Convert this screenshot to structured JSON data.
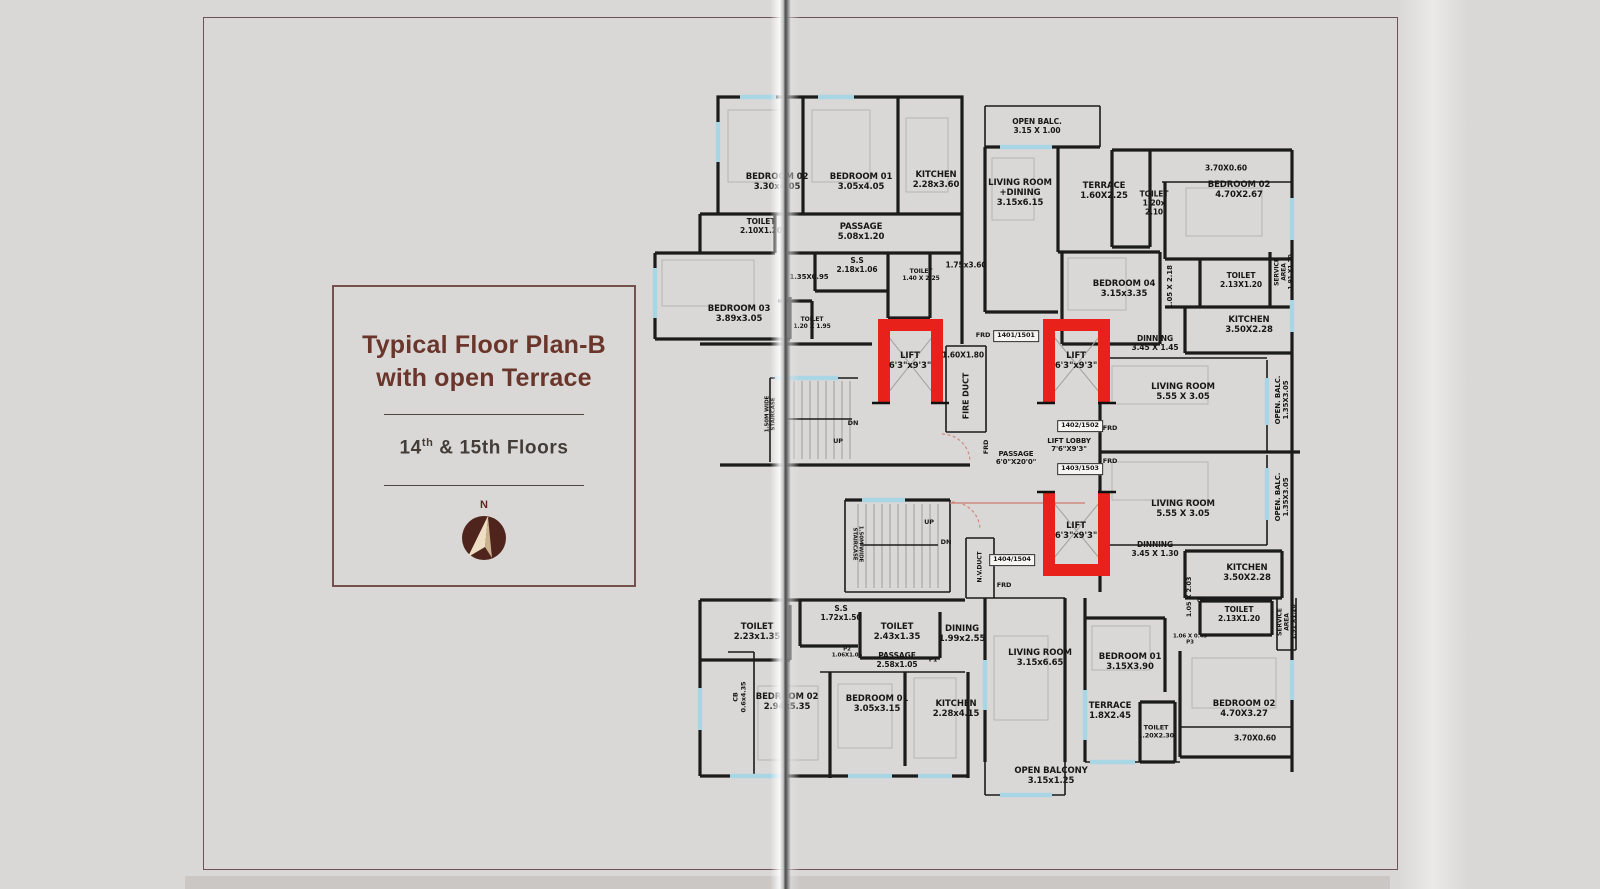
{
  "panel": {
    "title_line1": "Typical Floor Plan-B",
    "title_line2": "with open Terrace",
    "subtitle_prefix": "14",
    "subtitle_sup": "th",
    "subtitle_rest": " & 15th Floors",
    "compass_label": "N",
    "accent_color": "#6a352a"
  },
  "plan": {
    "lift_color": "#e8211b",
    "window_color": "#a9d6e5",
    "wall_color": "#1b1b1b",
    "labels": [
      {
        "lines": [
          "BEDROOM 02",
          "3.30x4.05"
        ],
        "x": 777,
        "y": 182
      },
      {
        "lines": [
          "BEDROOM 01",
          "3.05x4.05"
        ],
        "x": 861,
        "y": 182
      },
      {
        "lines": [
          "KITCHEN",
          "2.28x3.60"
        ],
        "x": 936,
        "y": 180
      },
      {
        "lines": [
          "OPEN BALC.",
          "3.15 X 1.00"
        ],
        "x": 1037,
        "y": 127,
        "fs": 7.5
      },
      {
        "lines": [
          "LIVING ROOM",
          "+DINING",
          "3.15x6.15"
        ],
        "x": 1020,
        "y": 193
      },
      {
        "lines": [
          "TERRACE",
          "1.60X2.25"
        ],
        "x": 1104,
        "y": 191
      },
      {
        "lines": [
          "TOILET",
          "1.20x",
          "2.10"
        ],
        "x": 1154,
        "y": 204,
        "fs": 7.5
      },
      {
        "lines": [
          "3.70X0.60"
        ],
        "x": 1226,
        "y": 169,
        "fs": 7.5
      },
      {
        "lines": [
          "BEDROOM 02",
          "4.70X2.67"
        ],
        "x": 1239,
        "y": 190
      },
      {
        "lines": [
          "TOILET",
          "2.10X1.20"
        ],
        "x": 761,
        "y": 227,
        "fs": 7.5
      },
      {
        "lines": [
          "PASSAGE",
          "5.08x1.20"
        ],
        "x": 861,
        "y": 232
      },
      {
        "lines": [
          "S.S",
          "2.18x1.06"
        ],
        "x": 857,
        "y": 266,
        "fs": 7.5
      },
      {
        "lines": [
          "TOILET",
          "1.40 X 2.25"
        ],
        "x": 921,
        "y": 275,
        "fs": 6
      },
      {
        "lines": [
          "1.75x3.60"
        ],
        "x": 966,
        "y": 266,
        "fs": 7.5
      },
      {
        "lines": [
          "1.35X0.95"
        ],
        "x": 809,
        "y": 277,
        "fs": 7
      },
      {
        "lines": [
          "BEDROOM 03",
          "3.89x3.05"
        ],
        "x": 739,
        "y": 314
      },
      {
        "lines": [
          "TOILET",
          "1.20 X 1.95"
        ],
        "x": 812,
        "y": 323,
        "fs": 6
      },
      {
        "lines": [
          "BEDROOM 04",
          "3.15x3.35"
        ],
        "x": 1124,
        "y": 289
      },
      {
        "lines": [
          "1.05 X 2.18"
        ],
        "x": 1170,
        "y": 287,
        "rot": -90,
        "fs": 7
      },
      {
        "lines": [
          "TOILET",
          "2.13X1.20"
        ],
        "x": 1241,
        "y": 281,
        "fs": 7.5
      },
      {
        "lines": [
          "SERVICE",
          "AREA",
          "1.91 X1.20"
        ],
        "x": 1284,
        "y": 272,
        "rot": -90,
        "fs": 6
      },
      {
        "lines": [
          "KITCHEN",
          "3.50X2.28"
        ],
        "x": 1249,
        "y": 325
      },
      {
        "lines": [
          "LIFT",
          "6'3\"x9'3\""
        ],
        "x": 910,
        "y": 361,
        "n": "lift-label"
      },
      {
        "lines": [
          "1.60X1.80"
        ],
        "x": 963,
        "y": 356,
        "fs": 7.5
      },
      {
        "lines": [
          "FIRE DUCT"
        ],
        "x": 966,
        "y": 396,
        "rot": -90,
        "fs": 8
      },
      {
        "lines": [
          "FRD"
        ],
        "x": 983,
        "y": 336,
        "fs": 6.5
      },
      {
        "lines": [
          "1401/1501"
        ],
        "x": 1016,
        "y": 336,
        "boxed": true,
        "n": "unit-number-badge"
      },
      {
        "lines": [
          "LIFT",
          "6'3\"x9'3\""
        ],
        "x": 1076,
        "y": 361,
        "n": "lift-label"
      },
      {
        "lines": [
          "DINNING",
          "3.45 X 1.45"
        ],
        "x": 1155,
        "y": 344,
        "fs": 7.5
      },
      {
        "lines": [
          "LIVING ROOM",
          "5.55 X 3.05"
        ],
        "x": 1183,
        "y": 392
      },
      {
        "lines": [
          "OPEN. BALC.",
          "1.35X3.05"
        ],
        "x": 1282,
        "y": 400,
        "rot": -90,
        "fs": 7
      },
      {
        "lines": [
          "1.50M WIDE",
          "STAIRCASE"
        ],
        "x": 771,
        "y": 414,
        "rot": -90,
        "fs": 5.5
      },
      {
        "lines": [
          "DN"
        ],
        "x": 853,
        "y": 424,
        "fs": 6.5
      },
      {
        "lines": [
          "UP"
        ],
        "x": 838,
        "y": 442,
        "fs": 6.5
      },
      {
        "lines": [
          "FRD"
        ],
        "x": 987,
        "y": 447,
        "rot": -90,
        "fs": 6.5
      },
      {
        "lines": [
          "PASSAGE",
          "6'0\"X20'0\""
        ],
        "x": 1016,
        "y": 458,
        "fs": 7
      },
      {
        "lines": [
          "LIFT LOBBY",
          "7'6\"X9'3\""
        ],
        "x": 1069,
        "y": 445,
        "fs": 7
      },
      {
        "lines": [
          "1402/1502"
        ],
        "x": 1080,
        "y": 426,
        "boxed": true,
        "n": "unit-number-badge"
      },
      {
        "lines": [
          "FRD"
        ],
        "x": 1110,
        "y": 429,
        "fs": 6.5
      },
      {
        "lines": [
          "1403/1503"
        ],
        "x": 1080,
        "y": 469,
        "boxed": true,
        "n": "unit-number-badge"
      },
      {
        "lines": [
          "FRD"
        ],
        "x": 1110,
        "y": 462,
        "fs": 6.5
      },
      {
        "lines": [
          "LIFT",
          "6'3\"x9'3\""
        ],
        "x": 1076,
        "y": 531,
        "n": "lift-label"
      },
      {
        "lines": [
          "LIVING ROOM",
          "5.55 X 3.05"
        ],
        "x": 1183,
        "y": 509
      },
      {
        "lines": [
          "OPEN. BALC.",
          "1.35X3.05"
        ],
        "x": 1282,
        "y": 497,
        "rot": -90,
        "fs": 7
      },
      {
        "lines": [
          "DINNING",
          "3.45 X 1.30"
        ],
        "x": 1155,
        "y": 550,
        "fs": 7.5
      },
      {
        "lines": [
          "1.50M WIDE",
          "STAIRCASE"
        ],
        "x": 857,
        "y": 544,
        "rot": 90,
        "fs": 5.5
      },
      {
        "lines": [
          "UP"
        ],
        "x": 929,
        "y": 523,
        "fs": 6.5
      },
      {
        "lines": [
          "DN"
        ],
        "x": 946,
        "y": 543,
        "fs": 6.5
      },
      {
        "lines": [
          "N.V.DUCT"
        ],
        "x": 980,
        "y": 567,
        "rot": -90,
        "fs": 6
      },
      {
        "lines": [
          "1404/1504"
        ],
        "x": 1012,
        "y": 560,
        "boxed": true,
        "n": "unit-number-badge"
      },
      {
        "lines": [
          "FRD"
        ],
        "x": 1004,
        "y": 586,
        "fs": 6.5
      },
      {
        "lines": [
          "KITCHEN",
          "3.50X2.28"
        ],
        "x": 1247,
        "y": 573
      },
      {
        "lines": [
          "1.05 X 2.03"
        ],
        "x": 1190,
        "y": 597,
        "rot": -90,
        "fs": 6.5
      },
      {
        "lines": [
          "P1"
        ],
        "x": 1201,
        "y": 600,
        "fs": 6
      },
      {
        "lines": [
          "TOILET",
          "2.13X1.20"
        ],
        "x": 1239,
        "y": 615,
        "fs": 7.5
      },
      {
        "lines": [
          "SERVICE",
          "AREA",
          "1.91 X1.20"
        ],
        "x": 1287,
        "y": 622,
        "rot": -90,
        "fs": 6
      },
      {
        "lines": [
          "1.06 X 0.45",
          "P3"
        ],
        "x": 1190,
        "y": 640,
        "fs": 5.5
      },
      {
        "lines": [
          "TOILET",
          "2.23x1.35"
        ],
        "x": 757,
        "y": 632
      },
      {
        "lines": [
          "S.S",
          "1.72x1.50"
        ],
        "x": 841,
        "y": 614,
        "fs": 7.5
      },
      {
        "lines": [
          "TOILET",
          "2.43x1.35"
        ],
        "x": 897,
        "y": 632
      },
      {
        "lines": [
          "DINING",
          "1.99x2.55"
        ],
        "x": 962,
        "y": 634
      },
      {
        "lines": [
          "P2",
          "1.06X1.05"
        ],
        "x": 847,
        "y": 653,
        "fs": 5.5
      },
      {
        "lines": [
          "PASSAGE",
          "2.58x1.05"
        ],
        "x": 897,
        "y": 661,
        "fs": 7.5
      },
      {
        "lines": [
          "P1"
        ],
        "x": 933,
        "y": 660,
        "fs": 6
      },
      {
        "lines": [
          "CB",
          "0.6x4.35"
        ],
        "x": 740,
        "y": 697,
        "rot": -90,
        "fs": 6.5
      },
      {
        "lines": [
          "BEDROOM 02",
          "2.94x5.35"
        ],
        "x": 787,
        "y": 702
      },
      {
        "lines": [
          "BEDROOM 01",
          "3.05x3.15"
        ],
        "x": 877,
        "y": 704
      },
      {
        "lines": [
          "KITCHEN",
          "2.28x4.15"
        ],
        "x": 956,
        "y": 709
      },
      {
        "lines": [
          "LIVING ROOM",
          "3.15x6.65"
        ],
        "x": 1040,
        "y": 658
      },
      {
        "lines": [
          "BEDROOM 01",
          "3.15X3.90"
        ],
        "x": 1130,
        "y": 662
      },
      {
        "lines": [
          "TERRACE",
          "1.8X2.45"
        ],
        "x": 1110,
        "y": 711
      },
      {
        "lines": [
          "TOILET",
          "1.20X2.30"
        ],
        "x": 1156,
        "y": 732,
        "fs": 6.5
      },
      {
        "lines": [
          "BEDROOM 02",
          "4.70X3.27"
        ],
        "x": 1244,
        "y": 709
      },
      {
        "lines": [
          "3.70X0.60"
        ],
        "x": 1255,
        "y": 739,
        "fs": 7.5
      },
      {
        "lines": [
          "OPEN BALCONY",
          "3.15x1.25"
        ],
        "x": 1051,
        "y": 776
      }
    ]
  }
}
